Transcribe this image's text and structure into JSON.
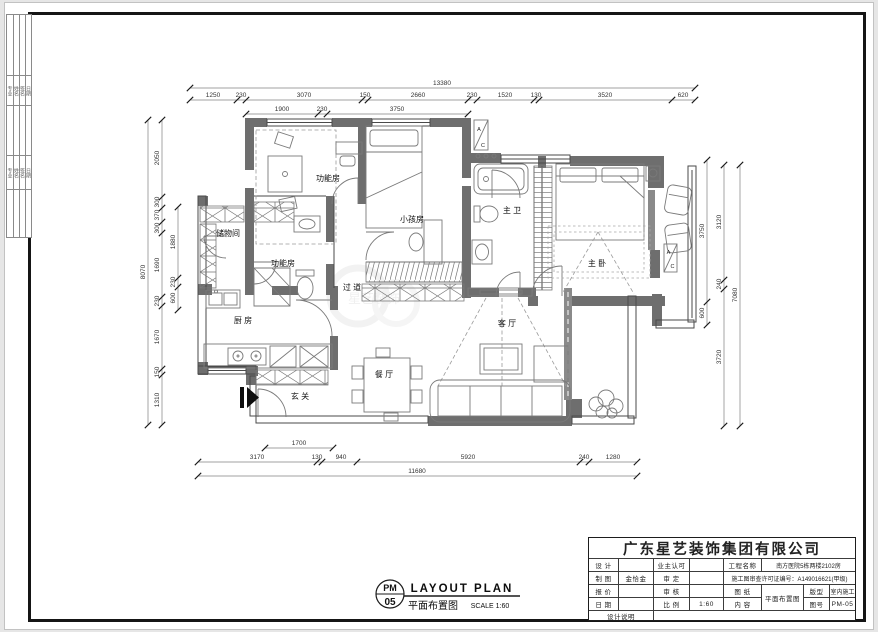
{
  "strip": {
    "g1": [
      "专业",
      "姓名",
      "签名",
      "日期"
    ],
    "g2": [
      "专业",
      "姓名",
      "签名",
      "日期"
    ]
  },
  "rooms": {
    "func_top": "功能房",
    "kids": "小孩房",
    "master_bath": "主 卫",
    "master_bed": "主 卧",
    "storage": "储物间",
    "func_mid": "功能房",
    "corridor": "过 道",
    "kitchen": "厨 房",
    "living": "客 厅",
    "dining": "餐 厅",
    "entry": "玄 关"
  },
  "markers": {
    "ac_a": "A",
    "ac_c": "C",
    "watermark": "星艺装饰"
  },
  "dims": {
    "top_total": "13380",
    "top": [
      "1250",
      "230",
      "3070",
      "150",
      "2660",
      "230",
      "1520",
      "130",
      "3520",
      "620"
    ],
    "top_sub": [
      "1900",
      "230",
      "3750"
    ],
    "left_total": "8070",
    "left": [
      "2050",
      "300",
      "370",
      "300",
      "1690",
      "230",
      "1670",
      "150",
      "1310"
    ],
    "left_inner": [
      "1880",
      "230",
      "600"
    ],
    "right_inner": [
      "3750",
      "600"
    ],
    "right": [
      "3120",
      "240",
      "3720"
    ],
    "right_total": "7080",
    "bottom_sub": "1700",
    "bottom": [
      "3170",
      "130",
      "940",
      "5920",
      "240",
      "1280"
    ],
    "bottom_total": "11680"
  },
  "caption": {
    "code_top": "PM",
    "code_bottom": "05",
    "title_en": "LAYOUT  PLAN",
    "title_cn": "平面布置图",
    "scale_note": "SCALE 1:60"
  },
  "title_block": {
    "company": "广东星艺装饰集团有限公司",
    "design_label": "设 计",
    "design_value": "",
    "owner_ok_label": "业主认可",
    "owner_ok_value": "",
    "project_label": "工程名称",
    "project_value": "南方医院5栋两楼2102房",
    "draft_label": "制 图",
    "draft_value": "金恰金",
    "approve_label": "审 定",
    "approve_value": "",
    "license": "施工图审查许可证编号：A149016621(甲级)",
    "quote_label": "报 价",
    "quote_value": "",
    "audit_label": "审 核",
    "audit_value": "",
    "sheet_label": "图 纸",
    "sheet_value": "平面布置图",
    "layout_label": "版型",
    "layout_value": "室内施工",
    "date_label": "日 期",
    "date_value": "",
    "scale_label": "比 例",
    "scale_value": "1:60",
    "content_label": "内 容",
    "number_label": "图号",
    "number_value": "PM-05",
    "notes_label": "设计说明"
  }
}
